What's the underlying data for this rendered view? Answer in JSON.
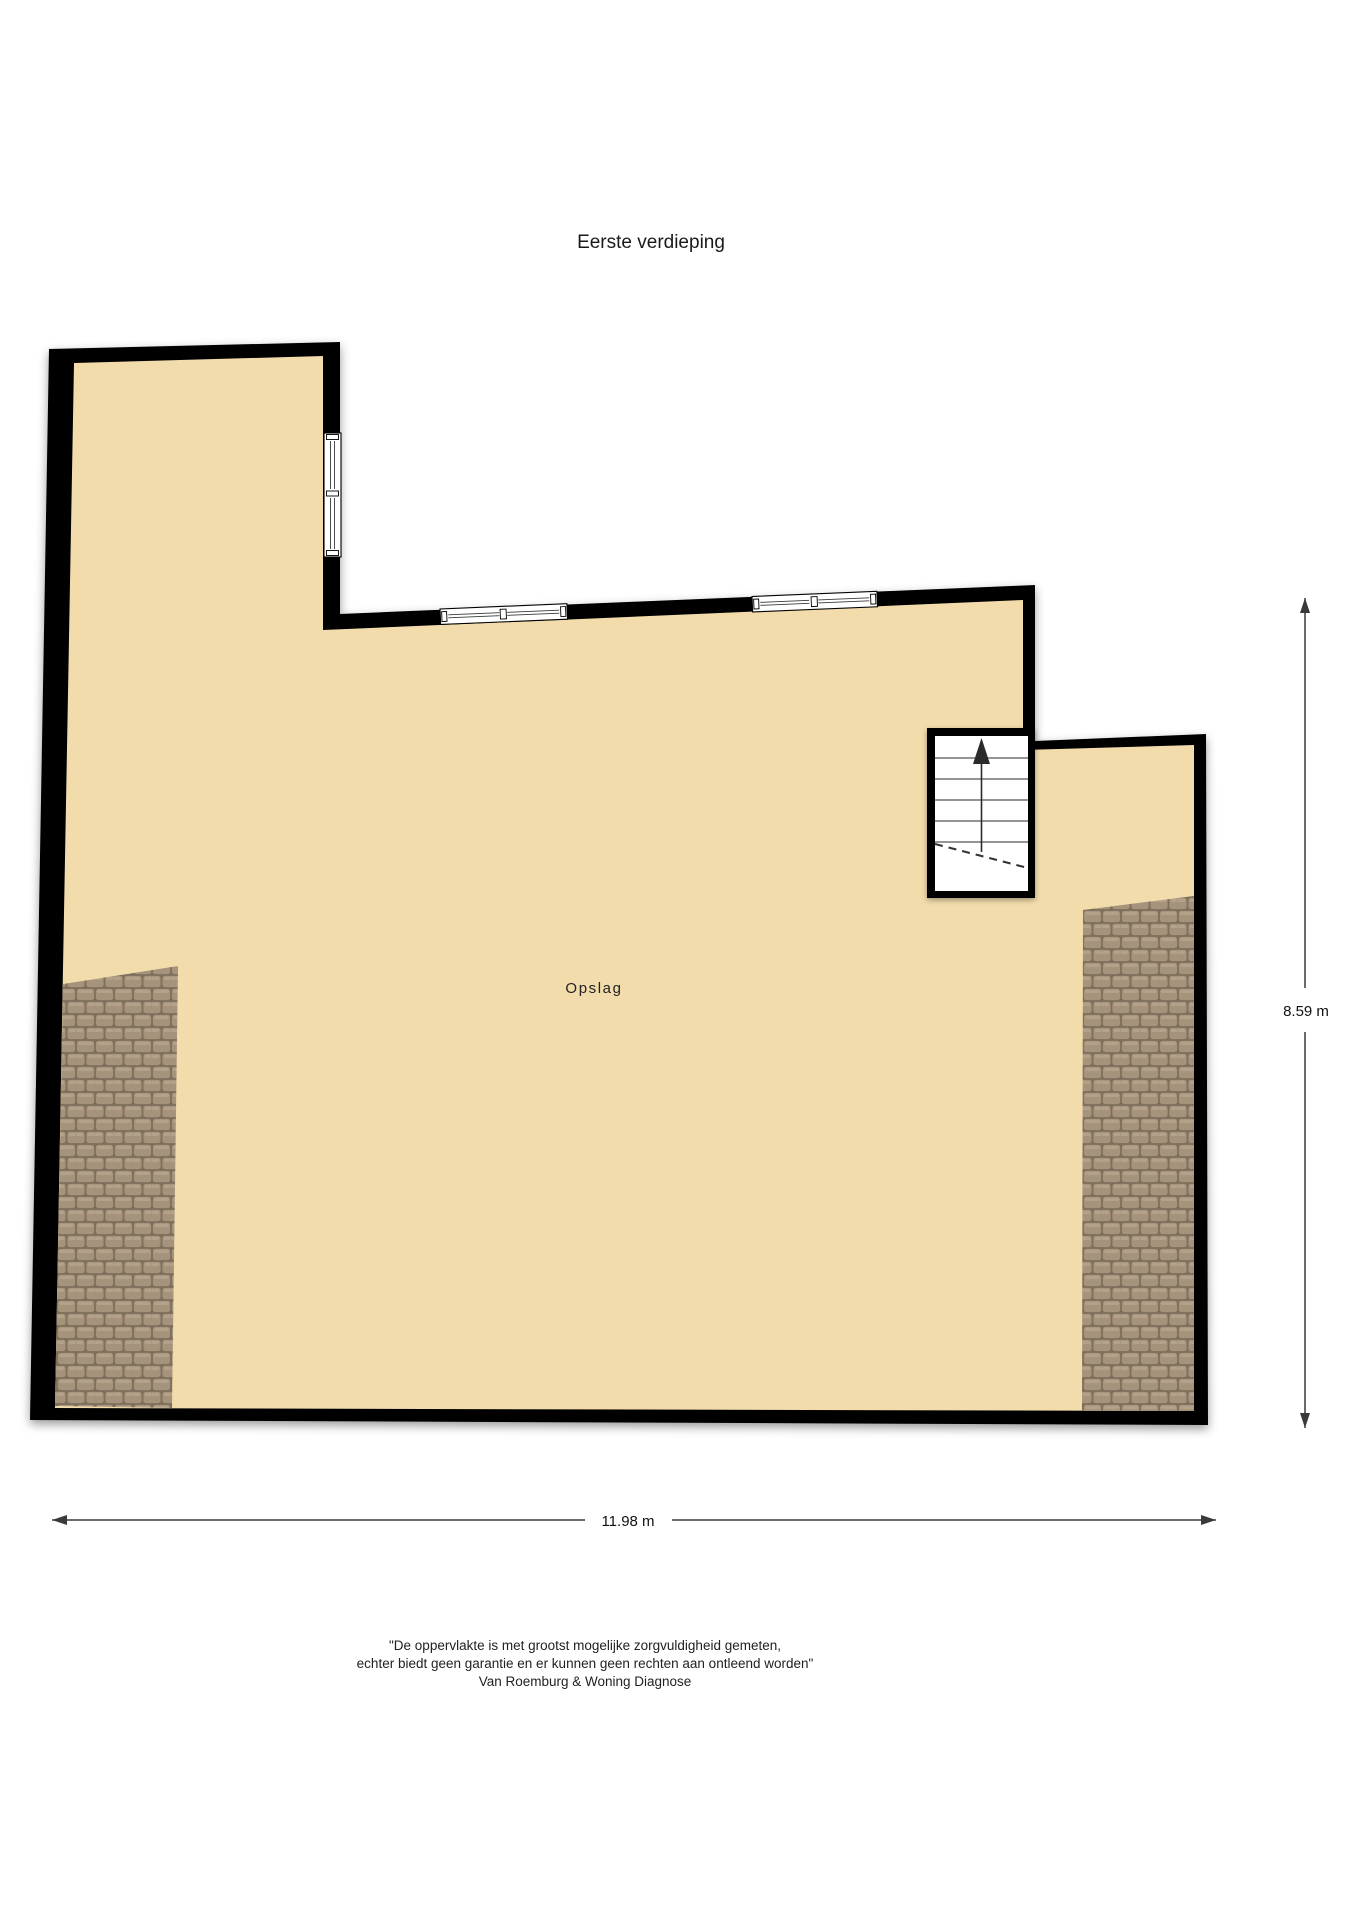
{
  "title": "Eerste verdieping",
  "plan": {
    "room_label": "Opslag"
  },
  "dimensions": {
    "height": "8.59 m",
    "width": "11.98 m"
  },
  "disclaimer": [
    "\"De oppervlakte is met grootst mogelijke zorgvuldigheid gemeten,",
    "echter biedt geen garantie en er kunnen geen rechten aan ontleend worden\"",
    "Van Roemburg & Woning Diagnose"
  ],
  "colors": {
    "wall": "#000000",
    "floor": "#f2dcab",
    "roof_tile": "#a6937c",
    "roof_tile_highlight": "#b5a48c",
    "roof_tile_gap": "#7e6f5c",
    "stair_arrow": "#2b2b2b",
    "dimension_line": "#3a3a3a",
    "window_fill": "#ffffff"
  }
}
